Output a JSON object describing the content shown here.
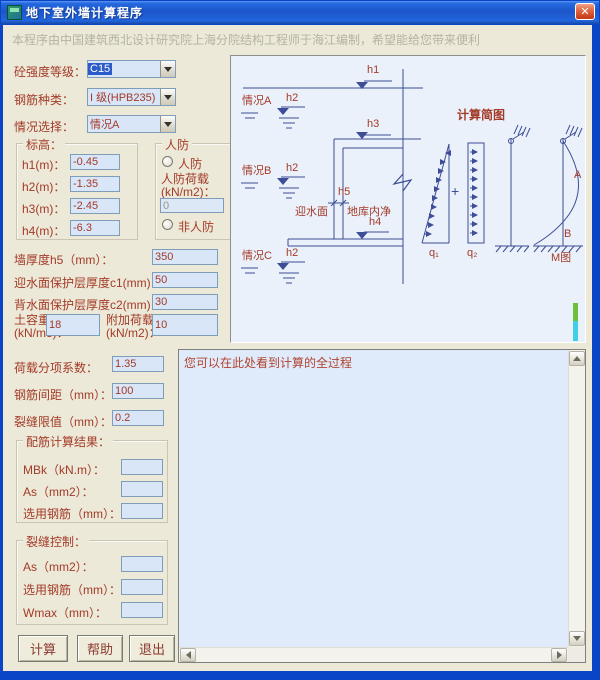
{
  "window": {
    "title": "地下室外墙计算程序",
    "close": "✕"
  },
  "note": "本程序由中国建筑西北设计研究院上海分院结构工程师于海江编制，希望能给您带来便利",
  "colors": {
    "label_red": "#A43A28",
    "diagram_line": "#3D4D96",
    "titlebar_blue": "#1C55C8",
    "field_bg": "#D9E6F7",
    "dialog_bg": "#ECE9D8"
  },
  "form": {
    "concrete": {
      "label": "砼强度等级：",
      "value": "C15"
    },
    "rebar": {
      "label": "钢筋种类：",
      "value": "I 级(HPB235)"
    },
    "case": {
      "label": "情况选择：",
      "value": "情况A"
    },
    "elevation": {
      "title": "标高：",
      "rows": [
        {
          "label": "h1(m)：",
          "value": "-0.45"
        },
        {
          "label": "h2(m)：",
          "value": "-1.35"
        },
        {
          "label": "h3(m)：",
          "value": "-2.45"
        },
        {
          "label": "h4(m)：",
          "value": "-6.3"
        }
      ]
    },
    "civil": {
      "title": "人防",
      "radio_yes": "人防",
      "load_label1": "人防荷载",
      "load_label2": "(kN/m2)：",
      "load_value": "0",
      "radio_no": "非人防"
    },
    "wall": {
      "label": "墙厚度h5（mm）：",
      "value": "350"
    },
    "cover1": {
      "label": "迎水面保护层厚度c1(mm)：",
      "value": "50"
    },
    "cover2": {
      "label": "背水面保护层厚度c2(mm)：",
      "value": "30"
    },
    "soil": {
      "label1": "土容重",
      "label2": "(kN/m3)：",
      "value": "18"
    },
    "extra": {
      "label1": "附加荷载",
      "label2": "(kN/m2)：",
      "value": "10"
    },
    "factor": {
      "label": "荷载分项系数：",
      "value": "1.35"
    },
    "spacing": {
      "label": "钢筋间距（mm）：",
      "value": "100"
    },
    "crack_limit": {
      "label": "裂缝限值（mm）：",
      "value": "0.2"
    },
    "results": {
      "title": "配筋计算结果：",
      "rows": [
        {
          "label": "MBk（kN.m）：",
          "value": ""
        },
        {
          "label": "As（mm2）：",
          "value": ""
        },
        {
          "label": "选用钢筋（mm）：",
          "value": ""
        }
      ]
    },
    "crack": {
      "title": "裂缝控制：",
      "rows": [
        {
          "label": "As（mm2）：",
          "value": ""
        },
        {
          "label": "选用钢筋（mm）：",
          "value": ""
        },
        {
          "label": "Wmax（mm）：",
          "value": ""
        }
      ]
    }
  },
  "buttons": {
    "calc": "计算",
    "help": "帮助",
    "exit": "退出"
  },
  "log": {
    "text": "您可以在此处看到计算的全过程"
  },
  "diagram": {
    "title": "计算简图",
    "h1": "h1",
    "h3": "h3",
    "h4": "h4",
    "h5": "h5",
    "case_a": "情况A",
    "case_b": "情况B",
    "case_c": "情况C",
    "h2_a": "h2",
    "h2_b": "h2",
    "h2_c": "h2",
    "water_facing": "迎水面",
    "basement_inner": "地库内净",
    "q1": "q₁",
    "q2": "q₂",
    "plus": "+",
    "support_a": "A",
    "support_b": "B",
    "m_label": "M图"
  }
}
